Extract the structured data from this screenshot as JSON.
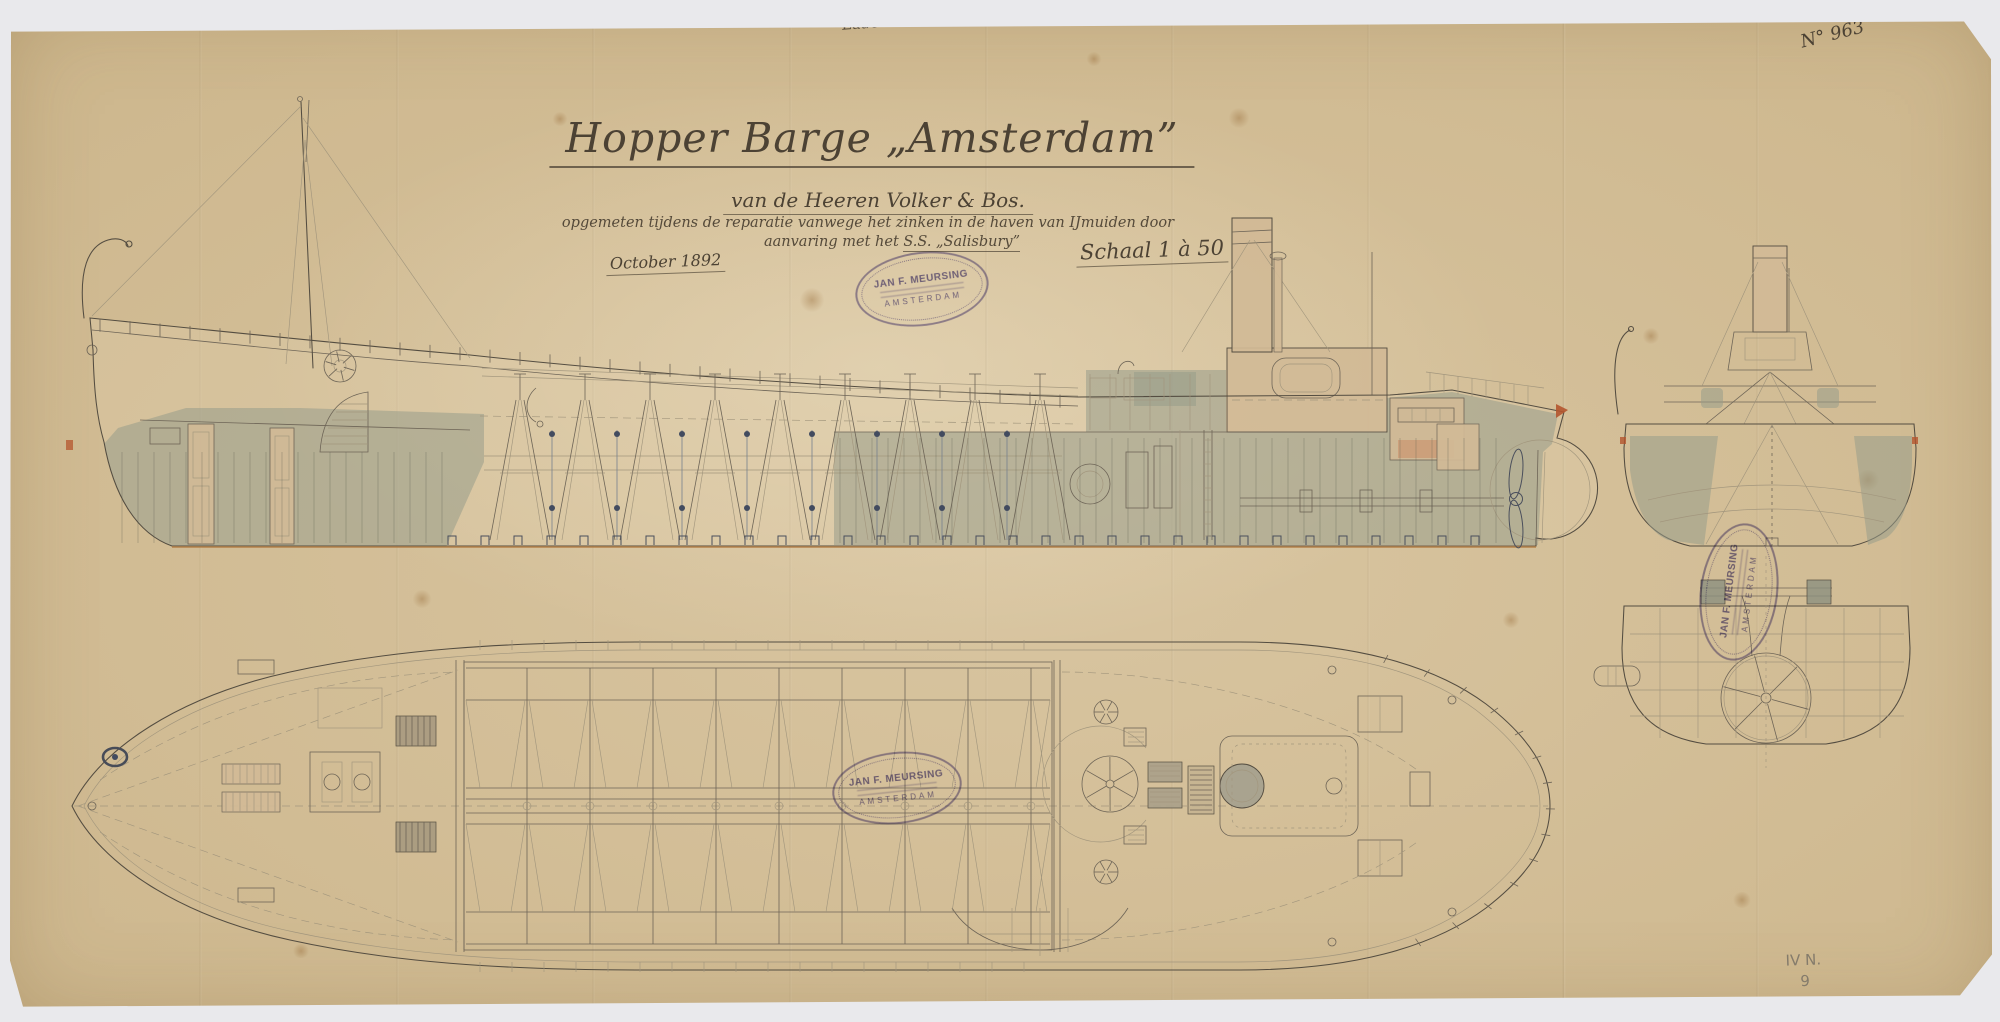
{
  "sheet": {
    "archive_note": "Lade 2",
    "sheet_number": "N° 963",
    "title": "Hopper Barge „Amsterdam”",
    "subtitle": "van de Heeren Volker & Bos.",
    "description_line1": "opgemeten tijdens de reparatie vanwege het zinken in de haven van IJmuiden door",
    "description_line2_prefix": "aanvaring met het ",
    "description_line2_ship": "S.S. „Salisbury”",
    "date_note": "October 1892",
    "scale_note": "Schaal 1 à 50",
    "corner_mark_line1": "IV N.",
    "corner_mark_line2": "9"
  },
  "stamp": {
    "line1": "JAN F. MEURSING",
    "line2": "AMSTERDAM"
  },
  "views": {
    "side_elevation": "side-elevation",
    "bow_section": "body-section-with-funnel",
    "stern_section": "stern-section-with-hand-wheel",
    "deck_plan": "deck-plan"
  },
  "colors": {
    "paper": "#d5c19d",
    "ink": "#544d41",
    "hull_wash": "#989d8a",
    "panel_buff": "#d1ba96",
    "stamp_purple": "#7268ae",
    "accent_red": "#b4552e"
  }
}
